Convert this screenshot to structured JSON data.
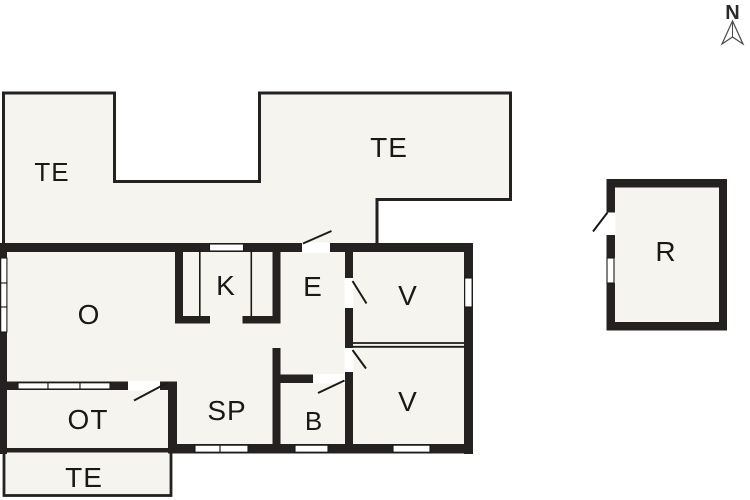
{
  "plan": {
    "type": "floor-plan",
    "compass": {
      "label": "N"
    },
    "rooms": [
      {
        "id": "te-north-west",
        "label": "TE"
      },
      {
        "id": "te-north-east",
        "label": "TE"
      },
      {
        "id": "o",
        "label": "O"
      },
      {
        "id": "k",
        "label": "K"
      },
      {
        "id": "e",
        "label": "E"
      },
      {
        "id": "v-upper",
        "label": "V"
      },
      {
        "id": "v-lower",
        "label": "V"
      },
      {
        "id": "sp",
        "label": "SP"
      },
      {
        "id": "b",
        "label": "B"
      },
      {
        "id": "ot",
        "label": "OT"
      },
      {
        "id": "te-south",
        "label": "TE"
      },
      {
        "id": "r",
        "label": "R"
      }
    ],
    "colors": {
      "wall": "#242120",
      "floor": "#f6f4ee",
      "background": "#ffffff",
      "line": "#1c1a19"
    }
  }
}
